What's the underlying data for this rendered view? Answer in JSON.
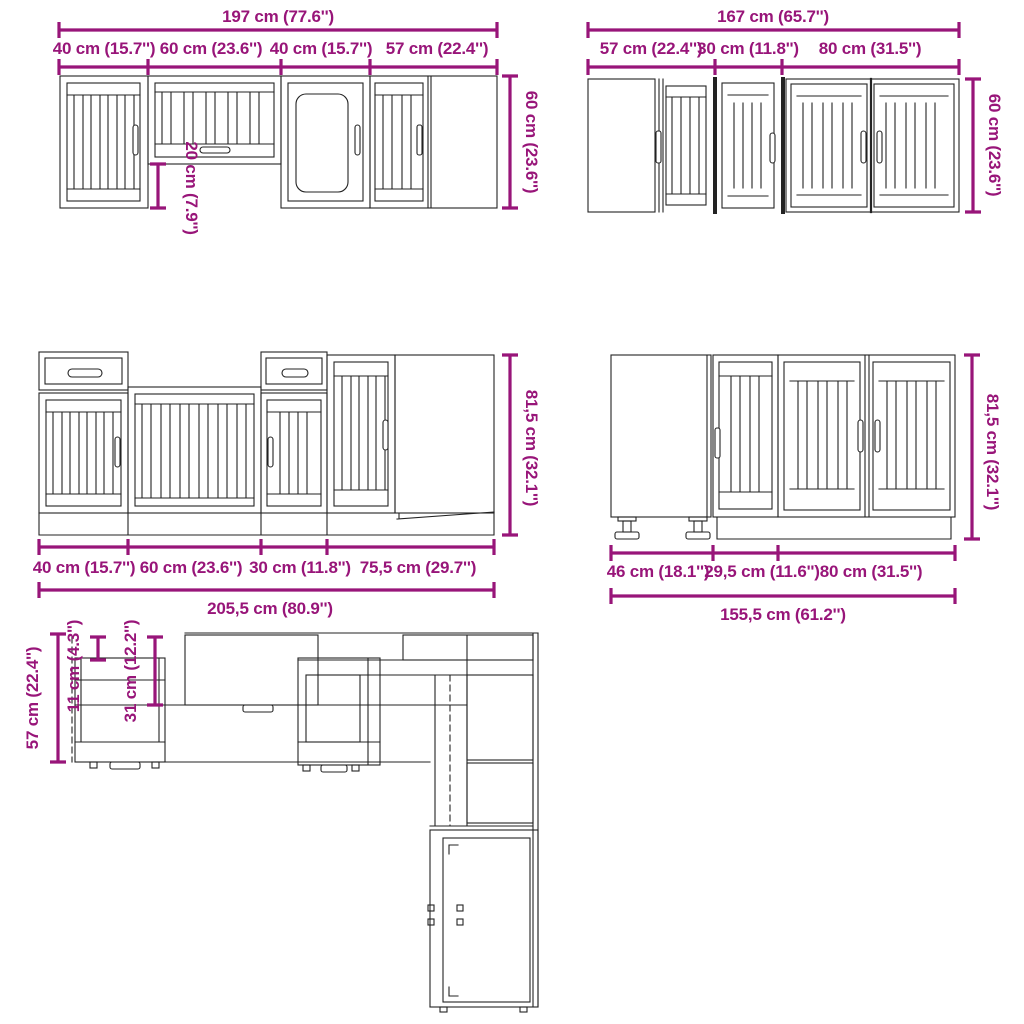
{
  "colors": {
    "dimension_accent": "#981579",
    "drawing_line": "#232323",
    "background": "#ffffff"
  },
  "figures": {
    "wall_set_a": {
      "total": "197 cm (77.6'')",
      "segments": [
        "40 cm (15.7'')",
        "60 cm (23.6'')",
        "40 cm (15.7'')",
        "57 cm (22.4'')"
      ],
      "height": "60 cm (23.6'')",
      "inner_height": "20 cm (7.9'')"
    },
    "wall_set_b": {
      "total": "167 cm (65.7'')",
      "segments": [
        "57 cm (22.4'')",
        "30 cm (11.8'')",
        "80 cm (31.5'')"
      ],
      "height": "60 cm (23.6'')"
    },
    "base_set_a": {
      "total": "205,5 cm (80.9'')",
      "segments": [
        "40 cm (15.7'')",
        "60 cm (23.6'')",
        "30 cm (11.8'')",
        "75,5 cm (29.7'')"
      ],
      "height": "81,5 cm (32.1'')"
    },
    "base_set_b": {
      "total": "155,5 cm (61.2'')",
      "segments": [
        "46 cm (18.1'')",
        "29,5 cm (11.6'')",
        "80 cm (31.5'')"
      ],
      "height": "81,5 cm (32.1'')"
    },
    "corner_layout": {
      "depth": "57 cm (22.4'')",
      "clearance_small": "11 cm (4.3'')",
      "clearance_mid": "31 cm (12.2'')"
    }
  }
}
